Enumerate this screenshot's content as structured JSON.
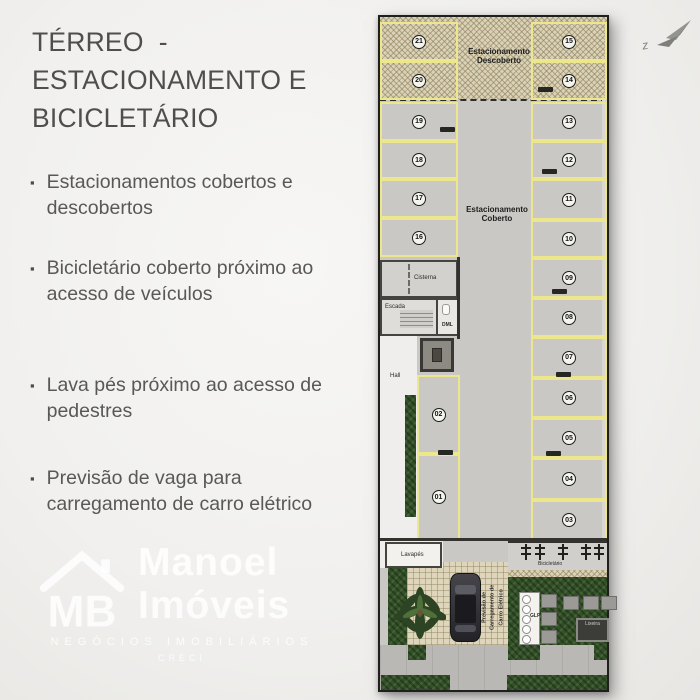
{
  "slide": {
    "title_lines": [
      "TÉRREO  -",
      "ESTACIONAMENTO E",
      "BICICLETÁRIO"
    ],
    "bullet_marker": "▪",
    "bullets": [
      "Estacionamentos cobertos e descobertos",
      "Bicicletário coberto próximo ao acesso de veículos",
      "Lava pés próximo ao acesso de pedestres",
      "Previsão de vaga para carregamento de carro elétrico"
    ]
  },
  "watermark": {
    "monogram": "MB",
    "name_top": "Manoel",
    "name_bottom": "Imóveis",
    "tagline": "NEGÓCIOS IMOBILIÁRIOS",
    "subline": "CRECI"
  },
  "plan": {
    "labels": {
      "descoberto_1": "Estacionamento",
      "descoberto_2": "Descoberto",
      "coberto_1": "Estacionamento",
      "coberto_2": "Coberto",
      "cisterna": "Cisterna",
      "escada": "Escada",
      "dml": "DML",
      "hall": "Hall",
      "lavapes": "Lavapés",
      "bicicletario": "Bicicletário",
      "glp": "GLP",
      "lixeira": "Lixeira",
      "ev_1": "Previsão de",
      "ev_2": "Carregamento de",
      "ev_3": "Carro Elétrico"
    },
    "stalls": [
      "21",
      "20",
      "15",
      "14",
      "19",
      "18",
      "17",
      "16",
      "13",
      "12",
      "11",
      "10",
      "09",
      "08",
      "07",
      "06",
      "05",
      "04",
      "03",
      "02",
      "01"
    ]
  },
  "colors": {
    "page_bg": "#f1f0ee",
    "text": "#585858",
    "plan_concrete": "#c9c8c4",
    "stall_line_yellow": "#ece68c",
    "uncovered_hatch": "#d9d2b8",
    "landscape_green": "#34502a",
    "sidewalk_gray": "#b9b8b5",
    "wall_dark": "#33322f"
  }
}
